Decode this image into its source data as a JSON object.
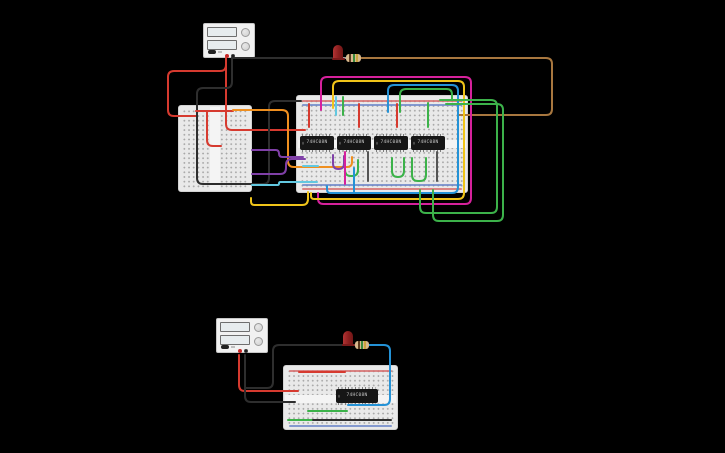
{
  "canvas": {
    "w": 725,
    "h": 453,
    "bg": "#000000"
  },
  "palette": {
    "red": "#d63a2f",
    "black": "#2e2e2e",
    "orange": "#ef8f1f",
    "purple": "#8040a8",
    "cyan": "#62c8e0",
    "magenta": "#d6219c",
    "yellow": "#f0c419",
    "green": "#3cb24a",
    "blue": "#2492d6",
    "brown": "#a8773f",
    "dark": "#555555",
    "lead": "#9e9e9e",
    "rail_red": "#d66a6a",
    "rail_blue": "#6a84c8"
  },
  "top_circuit": {
    "power_supply": {
      "rect": {
        "x": 203,
        "y": 23,
        "w": 52,
        "h": 35
      }
    },
    "breadboard_left": {
      "rect": {
        "x": 178,
        "y": 105,
        "w": 74,
        "h": 87
      }
    },
    "breadboard_main": {
      "rect": {
        "x": 296,
        "y": 95,
        "w": 172,
        "h": 98
      }
    },
    "ics": [
      {
        "label": "74HC08N",
        "rect": {
          "x": 300,
          "y": 136,
          "w": 34,
          "h": 14
        }
      },
      {
        "label": "74HC08N",
        "rect": {
          "x": 337,
          "y": 136,
          "w": 34,
          "h": 14
        }
      },
      {
        "label": "74HC08N",
        "rect": {
          "x": 374,
          "y": 136,
          "w": 34,
          "h": 14
        }
      },
      {
        "label": "74HC08N",
        "rect": {
          "x": 411,
          "y": 136,
          "w": 34,
          "h": 14
        }
      }
    ],
    "led": {
      "rect": {
        "x": 333,
        "y": 45,
        "w": 10,
        "h": 14
      }
    },
    "resistor": {
      "rect": {
        "x": 346,
        "y": 54,
        "w": 15,
        "h": 8
      }
    }
  },
  "bottom_circuit": {
    "power_supply": {
      "rect": {
        "x": 216,
        "y": 318,
        "w": 52,
        "h": 35
      }
    },
    "breadboard": {
      "rect": {
        "x": 283,
        "y": 365,
        "w": 115,
        "h": 65
      }
    },
    "ic": {
      "label": "74HC08N",
      "rect": {
        "x": 336,
        "y": 389,
        "w": 42,
        "h": 14
      }
    },
    "led": {
      "rect": {
        "x": 343,
        "y": 331,
        "w": 10,
        "h": 14
      }
    },
    "resistor": {
      "rect": {
        "x": 355,
        "y": 341,
        "w": 14,
        "h": 8
      }
    }
  },
  "parts": {
    "resistor_bands": [
      "#5a3a1e",
      "#3b8a3b",
      "#caa43e"
    ]
  },
  "wires": [
    {
      "c": "red",
      "pts": [
        [
          226,
          58
        ],
        [
          226,
          71
        ],
        [
          168,
          71
        ],
        [
          168,
          116
        ],
        [
          197,
          116
        ]
      ]
    },
    {
      "c": "red",
      "pts": [
        [
          226,
          58
        ],
        [
          226,
          130
        ],
        [
          305,
          130
        ]
      ]
    },
    {
      "c": "black",
      "pts": [
        [
          232,
          58
        ],
        [
          232,
          88
        ],
        [
          197,
          88
        ],
        [
          197,
          184
        ],
        [
          241,
          184
        ]
      ]
    },
    {
      "c": "black",
      "pts": [
        [
          241,
          184
        ],
        [
          269,
          184
        ],
        [
          269,
          101
        ],
        [
          301,
          101
        ]
      ]
    },
    {
      "c": "black",
      "pts": [
        [
          232,
          58
        ],
        [
          332,
          58
        ]
      ]
    },
    {
      "c": "red",
      "pts": [
        [
          196,
          111
        ],
        [
          233,
          111
        ]
      ]
    },
    {
      "c": "red",
      "pts": [
        [
          207,
          112
        ],
        [
          207,
          146
        ],
        [
          221,
          146
        ]
      ]
    },
    {
      "c": "orange",
      "pts": [
        [
          233,
          110
        ],
        [
          288,
          110
        ],
        [
          288,
          167
        ],
        [
          352,
          167
        ],
        [
          352,
          157
        ]
      ]
    },
    {
      "c": "purple",
      "pts": [
        [
          252,
          150
        ],
        [
          279,
          150
        ],
        [
          279,
          157
        ],
        [
          303,
          157
        ]
      ]
    },
    {
      "c": "purple",
      "pts": [
        [
          252,
          174
        ],
        [
          286,
          174
        ],
        [
          286,
          159
        ],
        [
          305,
          159
        ]
      ]
    },
    {
      "c": "purple",
      "pts": [
        [
          333,
          155
        ],
        [
          333,
          169
        ],
        [
          344,
          169
        ],
        [
          344,
          156
        ]
      ]
    },
    {
      "c": "cyan",
      "pts": [
        [
          252,
          185
        ],
        [
          279,
          185
        ],
        [
          279,
          182
        ],
        [
          317,
          182
        ]
      ]
    },
    {
      "c": "cyan",
      "pts": [
        [
          303,
          166
        ],
        [
          318,
          166
        ]
      ]
    },
    {
      "c": "lead",
      "pts": [
        [
          342,
          58
        ],
        [
          347,
          58
        ]
      ]
    },
    {
      "c": "brown",
      "pts": [
        [
          361,
          58
        ],
        [
          552,
          58
        ],
        [
          552,
          115
        ],
        [
          458,
          115
        ]
      ]
    },
    {
      "c": "magenta",
      "pts": [
        [
          321,
          110
        ],
        [
          321,
          77
        ],
        [
          471,
          77
        ],
        [
          471,
          204
        ],
        [
          318,
          204
        ],
        [
          318,
          193
        ]
      ]
    },
    {
      "c": "yellow",
      "pts": [
        [
          333,
          108
        ],
        [
          333,
          81
        ],
        [
          464,
          81
        ],
        [
          464,
          199
        ],
        [
          311,
          199
        ],
        [
          311,
          193
        ]
      ]
    },
    {
      "c": "blue",
      "pts": [
        [
          388,
          112
        ],
        [
          388,
          85
        ],
        [
          458,
          85
        ],
        [
          458,
          193
        ],
        [
          327,
          193
        ],
        [
          327,
          186
        ]
      ]
    },
    {
      "c": "green",
      "pts": [
        [
          400,
          112
        ],
        [
          400,
          89
        ],
        [
          452,
          89
        ],
        [
          452,
          100
        ]
      ]
    },
    {
      "c": "green",
      "pts": [
        [
          440,
          100
        ],
        [
          497,
          100
        ],
        [
          497,
          213
        ],
        [
          420,
          213
        ],
        [
          420,
          190
        ]
      ]
    },
    {
      "c": "green",
      "pts": [
        [
          446,
          104
        ],
        [
          503,
          104
        ],
        [
          503,
          221
        ],
        [
          433,
          221
        ],
        [
          433,
          190
        ]
      ]
    },
    {
      "c": "green",
      "pts": [
        [
          392,
          158
        ],
        [
          392,
          177
        ],
        [
          404,
          177
        ],
        [
          404,
          158
        ]
      ]
    },
    {
      "c": "green",
      "pts": [
        [
          412,
          158
        ],
        [
          412,
          181
        ],
        [
          426,
          181
        ],
        [
          426,
          158
        ]
      ]
    },
    {
      "c": "green",
      "pts": [
        [
          345,
          160
        ],
        [
          345,
          176
        ],
        [
          358,
          176
        ],
        [
          358,
          160
        ]
      ]
    },
    {
      "c": "green",
      "pts": [
        [
          428,
          103
        ],
        [
          428,
          127
        ]
      ]
    },
    {
      "c": "red",
      "pts": [
        [
          309,
          104
        ],
        [
          309,
          127
        ]
      ]
    },
    {
      "c": "red",
      "pts": [
        [
          359,
          104
        ],
        [
          359,
          127
        ]
      ]
    },
    {
      "c": "red",
      "pts": [
        [
          397,
          104
        ],
        [
          397,
          127
        ]
      ]
    },
    {
      "c": "yellow",
      "pts": [
        [
          308,
          192
        ],
        [
          308,
          205
        ],
        [
          251,
          205
        ],
        [
          251,
          198
        ]
      ]
    },
    {
      "c": "magenta",
      "pts": [
        [
          345,
          152
        ],
        [
          345,
          184
        ]
      ]
    },
    {
      "c": "blue",
      "pts": [
        [
          354,
          168
        ],
        [
          354,
          192
        ]
      ]
    },
    {
      "c": "dark",
      "pts": [
        [
          368,
          152
        ],
        [
          368,
          181
        ]
      ]
    },
    {
      "c": "dark",
      "pts": [
        [
          437,
          152
        ],
        [
          437,
          181
        ]
      ]
    },
    {
      "c": "cyan",
      "pts": [
        [
          336,
          97
        ],
        [
          336,
          115
        ]
      ]
    },
    {
      "c": "green",
      "pts": [
        [
          343,
          97
        ],
        [
          343,
          115
        ]
      ]
    },
    {
      "c": "red",
      "pts": [
        [
          239,
          355
        ],
        [
          239,
          391
        ],
        [
          298,
          391
        ]
      ]
    },
    {
      "c": "black",
      "pts": [
        [
          245,
          355
        ],
        [
          245,
          402
        ],
        [
          295,
          402
        ]
      ]
    },
    {
      "c": "black",
      "pts": [
        [
          245,
          388
        ],
        [
          273,
          388
        ],
        [
          273,
          345
        ],
        [
          343,
          345
        ]
      ]
    },
    {
      "c": "red",
      "pts": [
        [
          299,
          372
        ],
        [
          345,
          372
        ]
      ]
    },
    {
      "c": "lead",
      "pts": [
        [
          352,
          345
        ],
        [
          356,
          345
        ]
      ]
    },
    {
      "c": "blue",
      "pts": [
        [
          369,
          345
        ],
        [
          390,
          345
        ],
        [
          390,
          405
        ],
        [
          348,
          405
        ]
      ]
    },
    {
      "c": "green",
      "pts": [
        [
          308,
          411
        ],
        [
          347,
          411
        ]
      ]
    },
    {
      "c": "green",
      "pts": [
        [
          288,
          420
        ],
        [
          312,
          420
        ]
      ]
    },
    {
      "c": "black",
      "pts": [
        [
          313,
          420
        ],
        [
          391,
          420
        ]
      ]
    }
  ]
}
